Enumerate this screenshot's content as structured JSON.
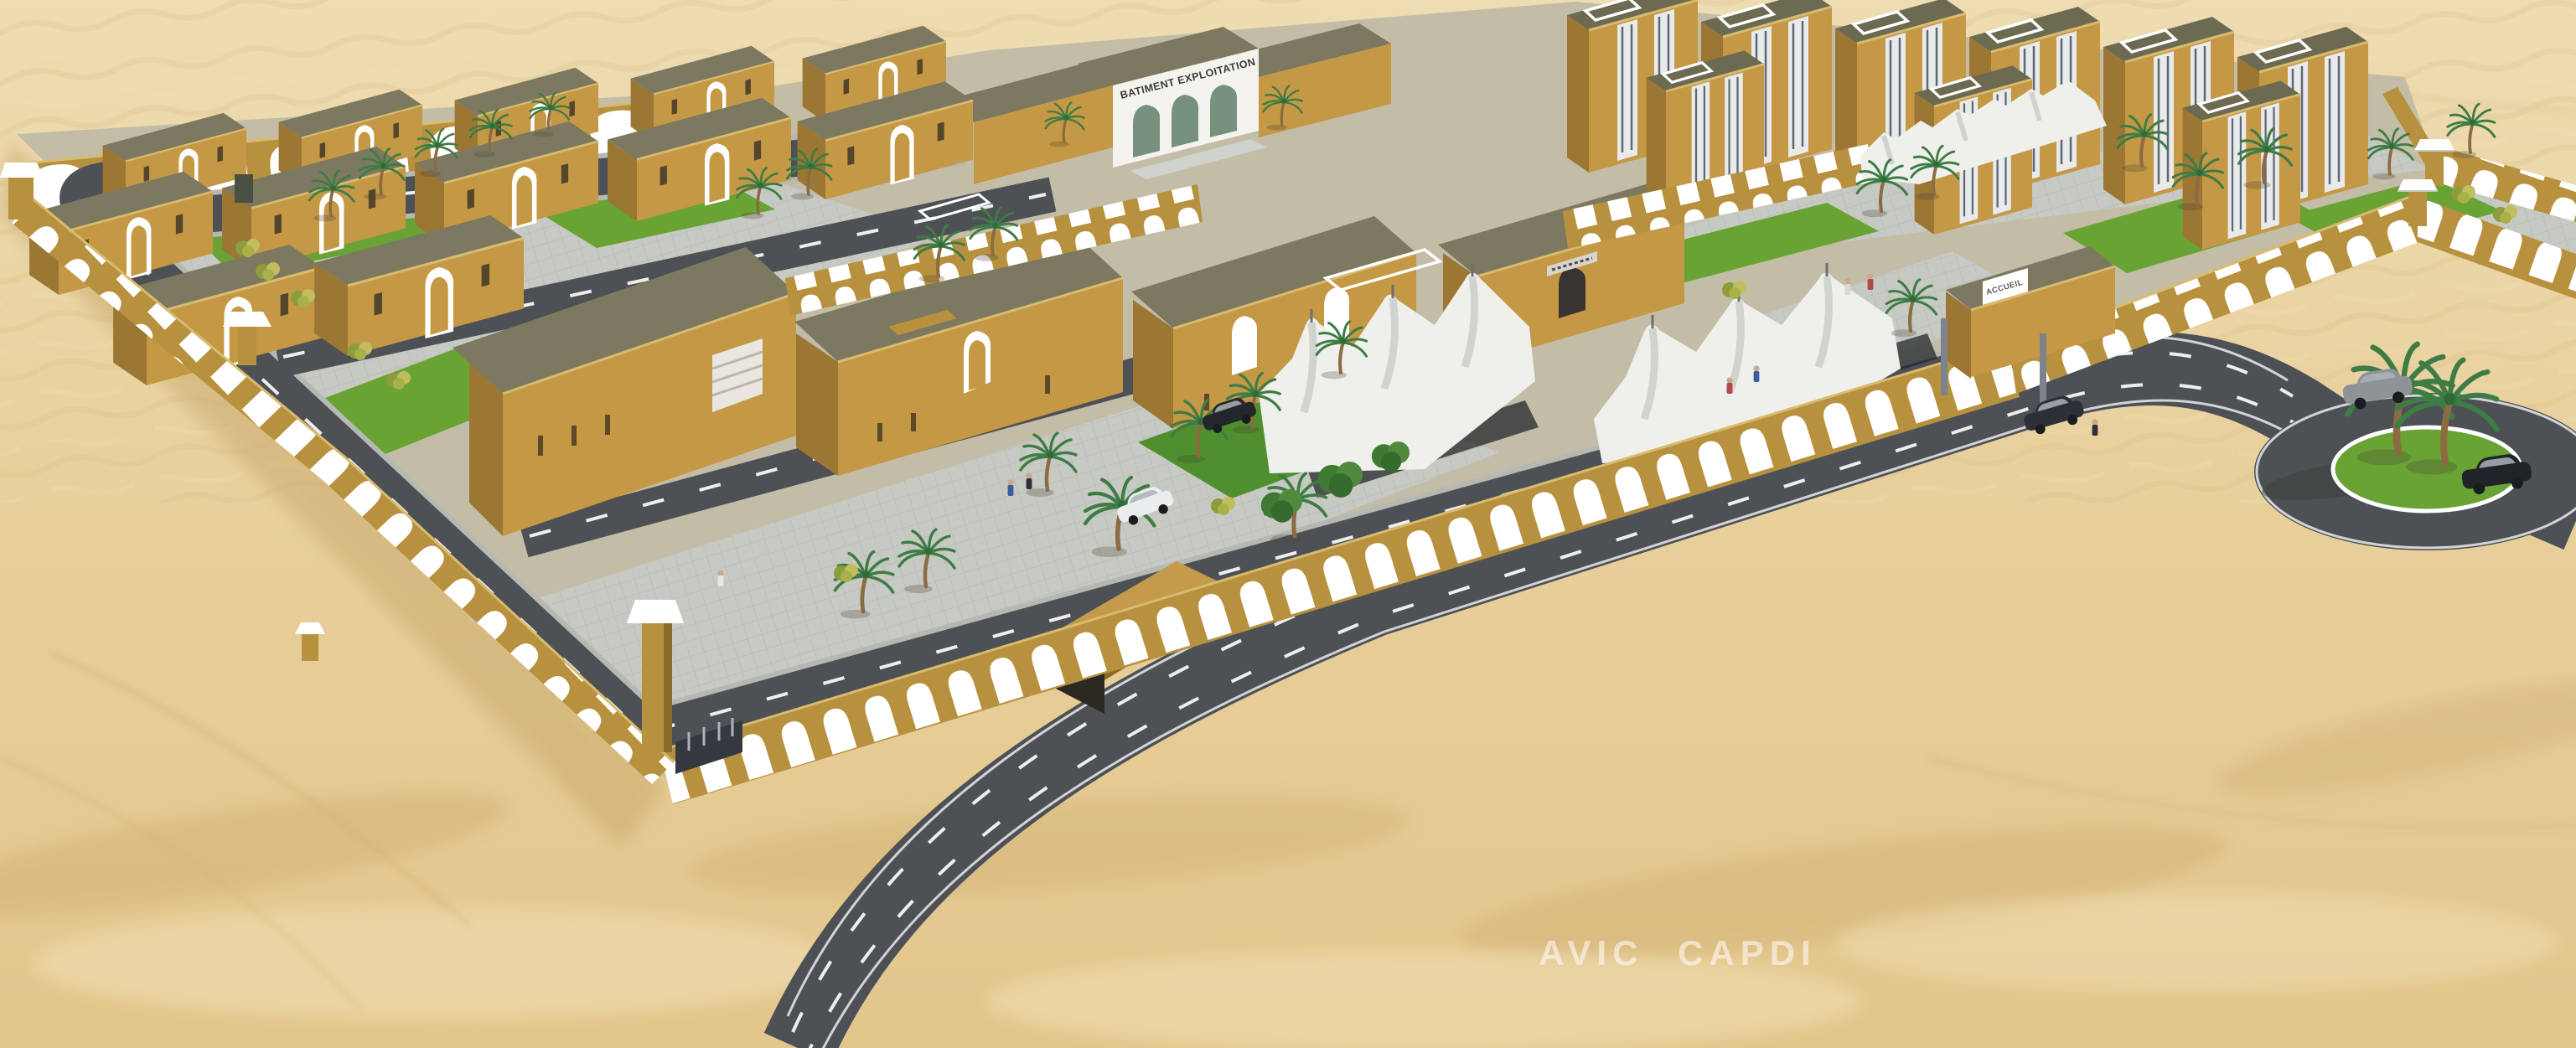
{
  "meta": {
    "type": "3d-architectural-rendering",
    "subject": "Aerial 3D render of a walled desert compound: ochre buildings with olive flat roofs, arched perimeter walls, palm trees, white car-park canopies, internal roads and an external roundabout in sand dunes"
  },
  "watermark": {
    "text": "AVIC  CAPDI"
  },
  "signs": {
    "exploitation_building": "BATIMENT EXPLOITATION",
    "reception_gate": "ACCUEIL"
  },
  "palette": {
    "sand": "#e7cd97",
    "sand-light": "#f1e1b8",
    "sand-shadow": "#d0ae72",
    "wall-tan": "#b8913f",
    "wall-cap": "#d9bb6f",
    "building-tan": "#c59845",
    "building-tan-dark": "#9c7733",
    "roof-olive": "#7c7960",
    "roof-olive-dark": "#6d6a52",
    "arch-white": "#ffffff",
    "road-asphalt": "#4d5156",
    "road-line": "#ffffff",
    "sidewalk": "#b6b8b2",
    "paver-grey": "#c7c9c3",
    "lawn-green": "#68a334",
    "lawn-dark": "#4f8f2e",
    "palm-green": "#3e7c45",
    "palm-trunk": "#8a6b42",
    "canopy-white": "#eff0ec",
    "canopy-shadow": "#c9ccc8",
    "glass-green": "#77917f",
    "facade-white": "#f4f3ee"
  }
}
